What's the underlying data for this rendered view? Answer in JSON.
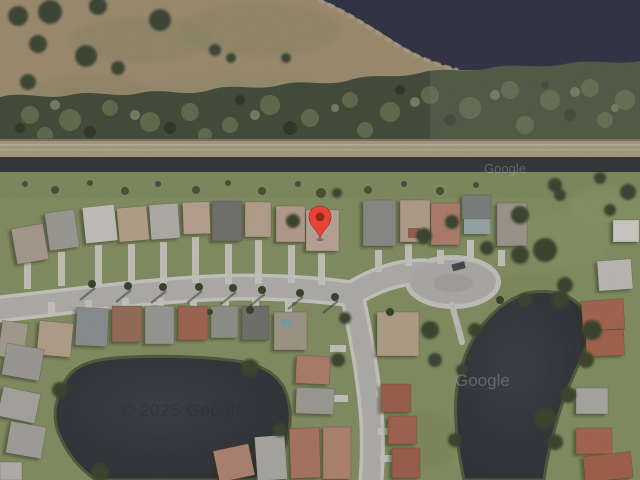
{
  "map": {
    "view_type": "satellite",
    "watermarks": {
      "copyright": "© 2025 Google",
      "brand_faint_right": "Google",
      "brand_faint_top": "Google"
    },
    "marker": {
      "label": "dropped-pin",
      "transform": "translate(320,238)",
      "body_color": "#EA4335",
      "dot_color": "#8E2A20"
    },
    "palette": {
      "field_tan": "#a7926e",
      "tree_band": "#36422a",
      "lake_water": "#20233a",
      "canal_bank": "#b2a383",
      "canal_water": "#25272c",
      "grass": "#87945c",
      "pond_water": "#24262e",
      "street_asphalt": "#bebcb7",
      "sidewalk": "#dad8d1"
    }
  }
}
